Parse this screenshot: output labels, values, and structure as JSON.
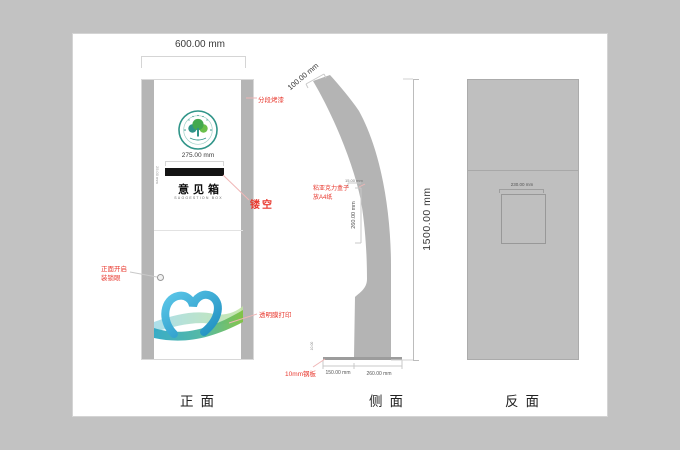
{
  "colors": {
    "annotation_red": "#e8392f",
    "panel_gray": "#b5b5b5",
    "back_gray": "#bfbfbf"
  },
  "front_view": {
    "width_dim": "600.00 mm",
    "slot_dim": "275.00 mm",
    "slot_height_dim": "25.00 mm",
    "box_title": "意见箱",
    "box_subtitle": "SUGGESTION BOX",
    "note_paint": "分段烤漆",
    "note_cutout": "镂空",
    "note_open_line1": "正面开启",
    "note_open_line2": "装锁眼",
    "note_film": "透明膜打印",
    "caption": "正面"
  },
  "side_view": {
    "top_dim": "100.00 mm",
    "height_dim": "1500.00 mm",
    "note_acrylic_line1": "粘亚克力盒子",
    "note_acrylic_line2": "放A4纸",
    "acrylic_top_dim": "15.00 mm",
    "acrylic_height_dim": "260.00 mm",
    "plate_thickness_dim": "10.00",
    "note_plate": "10mm钢板",
    "base_front_dim": "150.00 mm",
    "base_depth_dim": "260.00 mm",
    "caption": "侧面"
  },
  "back_view": {
    "door_dim": "230.00 mm",
    "caption": "反面"
  }
}
